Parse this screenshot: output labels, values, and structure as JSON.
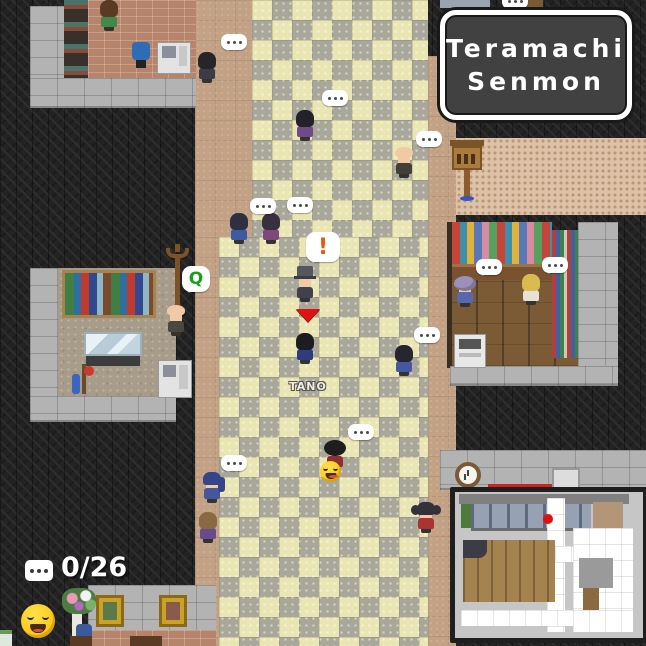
{
  "hud": {
    "location_label": {
      "line1": "Teramachi",
      "line2": "Senmon"
    },
    "chat_counter": {
      "icon": "speech-bubble-icon",
      "count": "0/26"
    },
    "emote_icon": "laughing-emoji",
    "minimap": {
      "player_dot_color": "#e01010"
    }
  },
  "player": {
    "name": "TANO",
    "marker": "red-down-arrow"
  },
  "colors": {
    "alert_orange": "#e8590c",
    "interact_green": "#18a018",
    "player_arrow_red": "#e01212",
    "plate_bg": "#414141",
    "tile_light": "#e9e6b3",
    "tile_dark": "#a8a79a",
    "dirt": "#c2a184"
  },
  "npcs": [
    {
      "id": "npc-shop-clerk",
      "x": 98,
      "y": 0,
      "style": "longhair",
      "hair": "#5a3a22",
      "outfit": "#3f8a4a"
    },
    {
      "id": "npc-street-top",
      "x": 196,
      "y": 52,
      "style": "longhair",
      "hair": "#26262a",
      "outfit": "#3c3c46",
      "bubble": {
        "type": "dots",
        "x": 221,
        "y": 34
      }
    },
    {
      "id": "npc-street-upper",
      "x": 294,
      "y": 110,
      "style": "longhair",
      "hair": "#222228",
      "outfit": "#6e4a86",
      "bubble": {
        "type": "dots",
        "x": 322,
        "y": 90
      }
    },
    {
      "id": "npc-pair-left",
      "x": 228,
      "y": 213,
      "style": "longhair",
      "hair": "#2c3040",
      "outfit": "#3e5aa2",
      "bubble": {
        "type": "dots",
        "x": 250,
        "y": 198
      }
    },
    {
      "id": "npc-pair-right",
      "x": 260,
      "y": 213,
      "style": "longhair",
      "hair": "#38303e",
      "outfit": "#7e4878",
      "bubble": {
        "type": "dots",
        "x": 287,
        "y": 197
      }
    },
    {
      "id": "npc-guide-tophat",
      "x": 294,
      "y": 271,
      "style": "tophat",
      "hair": "#56565e",
      "outfit": "#40404e",
      "bubble": {
        "type": "glyph",
        "glyph": "!",
        "color": "#e8590c",
        "x": 306,
        "y": 232,
        "w": 34,
        "h": 30,
        "size": 22
      }
    },
    {
      "id": "player-tano",
      "x": 294,
      "y": 333,
      "style": "longhair",
      "hair": "#1c1c22",
      "outfit": "#2c3c7c"
    },
    {
      "id": "npc-monk",
      "x": 393,
      "y": 147,
      "style": "bald",
      "hair": "#f1c9a4",
      "outfit": "#423e38",
      "bubble": {
        "type": "dots",
        "x": 416,
        "y": 131
      }
    },
    {
      "id": "npc-mid-street",
      "x": 393,
      "y": 345,
      "style": "longhair",
      "hair": "#26262e",
      "outfit": "#4656a0",
      "bubble": {
        "type": "dots",
        "x": 414,
        "y": 327
      }
    },
    {
      "id": "npc-afro-smiley",
      "x": 324,
      "y": 440,
      "style": "afro",
      "hair": "#1e1e1e",
      "outfit": "#8c3030",
      "bubble": {
        "type": "dots",
        "x": 348,
        "y": 424
      }
    },
    {
      "id": "npc-ponytail-blue",
      "x": 201,
      "y": 472,
      "style": "ponytail",
      "hair": "#35458c",
      "outfit": "#46569c",
      "bubble": {
        "type": "dots",
        "x": 221,
        "y": 455
      }
    },
    {
      "id": "npc-lower-left",
      "x": 197,
      "y": 512,
      "style": "longhair",
      "hair": "#8a6a40",
      "outfit": "#6a4a8c"
    },
    {
      "id": "npc-pigtails-red",
      "x": 415,
      "y": 502,
      "style": "pigtails",
      "hair": "#34303c",
      "outfit": "#aa3434"
    },
    {
      "id": "npc-granny-perm",
      "x": 454,
      "y": 276,
      "style": "perm",
      "hair": "#9b90b8",
      "outfit": "#5868b0",
      "bubble": {
        "type": "dots",
        "x": 476,
        "y": 259
      }
    },
    {
      "id": "npc-blonde-clerk",
      "x": 520,
      "y": 274,
      "style": "longhair",
      "hair": "#d8bc50",
      "outfit": "#e6e2d6",
      "bubble": {
        "type": "dots",
        "x": 542,
        "y": 257
      }
    },
    {
      "id": "npc-old-man",
      "x": 165,
      "y": 305,
      "style": "bald",
      "hair": "#f1c9a4",
      "outfit": "#4a4640",
      "bubble": {
        "type": "glyph",
        "glyph": "Q",
        "color": "#18a018",
        "x": 182,
        "y": 266,
        "w": 28,
        "h": 26,
        "size": 17
      }
    }
  ]
}
